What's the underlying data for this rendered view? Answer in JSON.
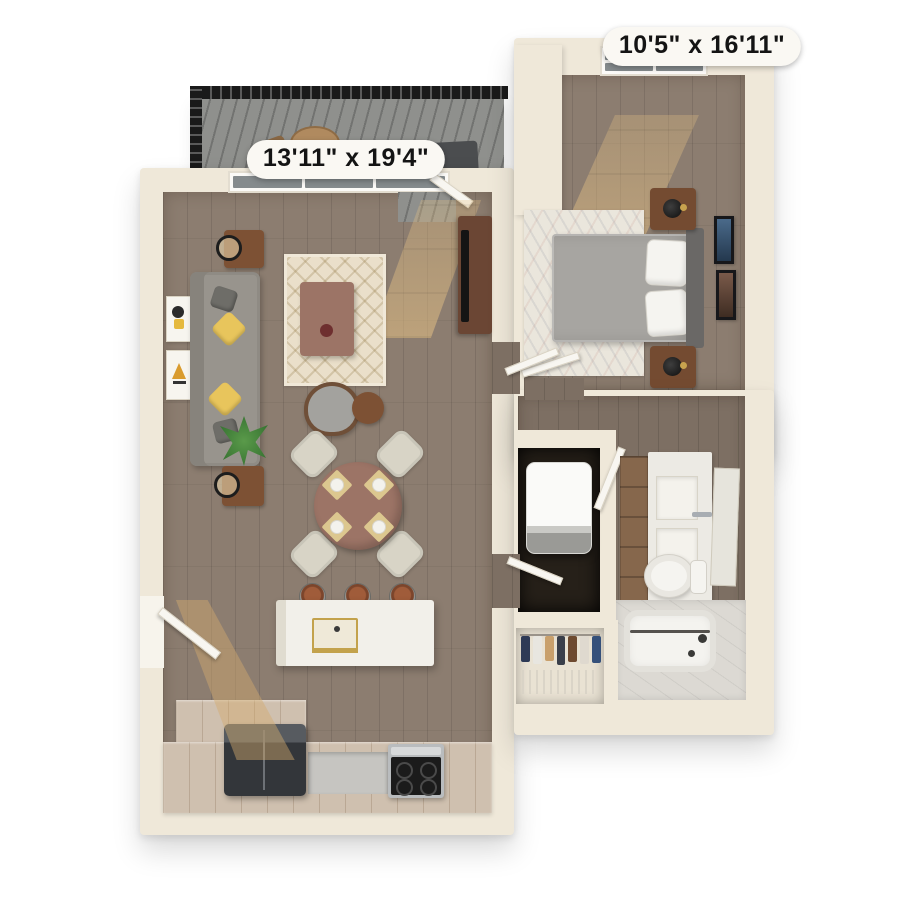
{
  "scene": {
    "description": "3D top-down rendered floor plan of a one-bedroom apartment on a white background",
    "background": "#ffffff"
  },
  "labels": {
    "living_dining_dimensions": "13'11\" x 19'4\"",
    "bedroom_dimensions": "10'5\" x 16'11\""
  },
  "rooms": [
    {
      "name": "balcony",
      "furniture": [
        "black-metal-railing",
        "gray-plank-deck",
        "outdoor-table",
        "outdoor-chair",
        "lounge-chairs"
      ]
    },
    {
      "name": "living-dining-room",
      "dimensions": "13'11\" x 19'4\"",
      "furniture": [
        "window-wall",
        "balcony-door",
        "gray-sofa",
        "yellow-throw-pillows",
        "end-tables",
        "wall-art",
        "patterned-area-rug",
        "coffee-table",
        "armchair",
        "round-side-table",
        "potted-plant",
        "round-dining-table",
        "four-dining-chairs",
        "place-settings",
        "tv-console",
        "tv"
      ]
    },
    {
      "name": "kitchen",
      "furniture": [
        "island-with-sink",
        "brass-faucet",
        "three-bar-stools",
        "refrigerator",
        "range",
        "wood-cabinets",
        "entry-door"
      ]
    },
    {
      "name": "bedroom",
      "dimensions": "10'5\" x 16'11\"",
      "furniture": [
        "window",
        "bed",
        "white-pillows",
        "gray-duvet",
        "headboard",
        "two-nightstands",
        "black-lamps",
        "wall-frames",
        "area-rug",
        "door"
      ]
    },
    {
      "name": "laundry-closet",
      "furniture": [
        "stacked-washer-dryer",
        "closet-door"
      ]
    },
    {
      "name": "bathroom",
      "furniture": [
        "vanity-cabinet",
        "white-counter",
        "sink",
        "faucet",
        "mirror",
        "toilet",
        "bathtub",
        "marble-deck",
        "door"
      ]
    },
    {
      "name": "closet",
      "furniture": [
        "hanging-clothes",
        "wire-shelf"
      ]
    }
  ],
  "colors": {
    "wall": "#efe8d9",
    "floor-wood": "#8c7d70",
    "floor-wood-dark": "#7d6f63",
    "floor-kitchen": "#cfc0af",
    "deck": "#8f908d",
    "railing": "#1a1a1a",
    "sofa": "#98948d",
    "pillow": "#e8c55c",
    "rug": "#eadfca",
    "rug2": "#eae6dc",
    "mauve": "#9c7466",
    "chair": "#d8d4c6",
    "wood-brown": "#7d5134",
    "island": "#f2f0ea",
    "brass": "#c3a24c",
    "fridge": "#33363a",
    "steel": "#b9bcbe",
    "duvet": "#a7a5a1",
    "headboard": "#6a6866",
    "white-fixture": "#f5f4f0",
    "marble": "#dcd9d3",
    "plant": "#47823f",
    "closet-dark": "#262019",
    "glass": "#858b8d",
    "label-bg": "#faf8f3",
    "label-ink": "#141414",
    "sun": "#e4c084"
  }
}
